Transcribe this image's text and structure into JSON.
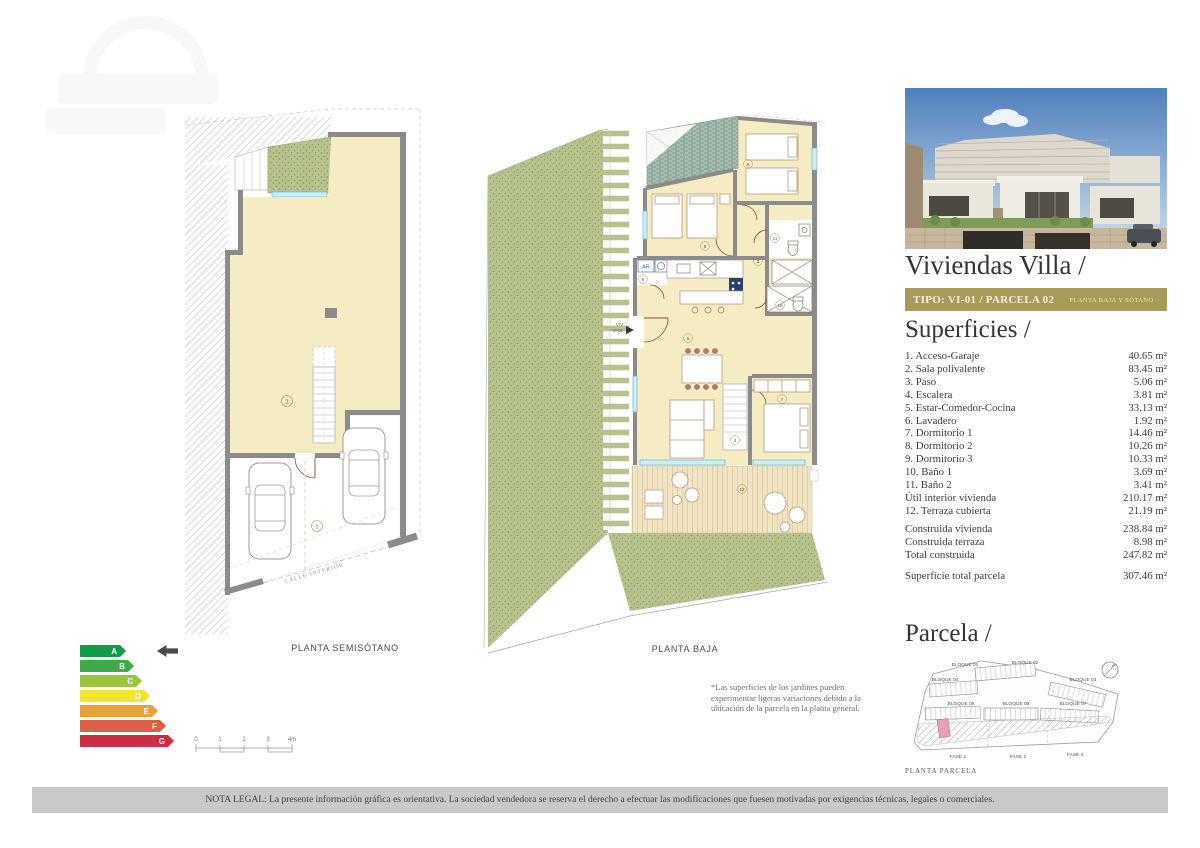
{
  "right_panel": {
    "title": "Viviendas Villa /",
    "tipo_bar": {
      "main": "TIPO: VI-01 / PARCELA 02",
      "sub": "PLANTA BAJA Y SÓTANO",
      "bg_color": "#a89a59"
    },
    "superficies": {
      "heading": "Superficies /",
      "rows": [
        {
          "label": "1. Acceso-Garaje",
          "value": "40.65 m²"
        },
        {
          "label": "2. Sala polivalente",
          "value": "83.45 m²"
        },
        {
          "label": "3. Paso",
          "value": "5.06 m²"
        },
        {
          "label": "4. Escalera",
          "value": "3.81 m²"
        },
        {
          "label": "5. Estar-Comedor-Cocina",
          "value": "33.13 m²"
        },
        {
          "label": "6. Lavadero",
          "value": "1.92 m²"
        },
        {
          "label": "7. Dormitorio 1",
          "value": "14.46 m²"
        },
        {
          "label": "8. Dormitorio 2",
          "value": "10.26 m²"
        },
        {
          "label": "9. Dormitorio 3",
          "value": "10.33 m²"
        },
        {
          "label": "10. Baño 1",
          "value": "3.69 m²"
        },
        {
          "label": "11. Baño 2",
          "value": "3.41 m²"
        },
        {
          "label": "Útil interior vivienda",
          "value": "210.17 m²"
        },
        {
          "label": "12. Terraza cubierta",
          "value": "21.19 m²"
        }
      ],
      "totals": [
        {
          "label": "Construida vivienda",
          "value": "238.84 m²"
        },
        {
          "label": "Construida terraza",
          "value": "8.98 m²"
        },
        {
          "label": "Total construida",
          "value": "247.82 m²"
        }
      ],
      "parcel_total": {
        "label": "Superficie total parcela",
        "value": "307.46 m²"
      }
    },
    "parcela": {
      "heading": "Parcela /",
      "caption": "PLANTA PARCELA",
      "blocks": [
        "BLOQUE 01",
        "BLOQUE 02",
        "BLOQUE 03",
        "BLOQUE 04",
        "BLOQUE 05",
        "BLOQUE 06",
        "BLOQUE 07"
      ],
      "fases": [
        "FASE 1",
        "FASE 2",
        "FASE 3"
      ],
      "highlight_color": "#e79fb4"
    }
  },
  "plans": {
    "semisotano": {
      "label": "PLANTA SEMISÓTANO",
      "street_label": "CALLE INTERIOR",
      "rooms": [
        "1",
        "2"
      ]
    },
    "baja": {
      "label": "PLANTA BAJA",
      "unit_label": {
        "line1": "VIV",
        "line2": "VI-01"
      },
      "ar_label": "AR",
      "rooms": [
        "3",
        "4",
        "5",
        "6",
        "7",
        "8",
        "9",
        "10",
        "11",
        "12"
      ]
    },
    "note": "*Las superficies de los jardines pueden experimentar ligeras variaciones debido a la ubicación de la parcela en la planta general."
  },
  "energy": {
    "grades": [
      {
        "letter": "A",
        "color": "#119a48"
      },
      {
        "letter": "B",
        "color": "#3cab49"
      },
      {
        "letter": "C",
        "color": "#9cc43c"
      },
      {
        "letter": "D",
        "color": "#f2e434"
      },
      {
        "letter": "E",
        "color": "#e5a33c"
      },
      {
        "letter": "F",
        "color": "#dd5f45"
      },
      {
        "letter": "G",
        "color": "#cb2e44"
      }
    ],
    "selected": "A",
    "arrow_color": "#4a4a4a"
  },
  "scale_bar": {
    "ticks": [
      "0",
      "1",
      "2",
      "3",
      "4m"
    ]
  },
  "legal": "NOTA LEGAL: La presente información gráfica es orientativa. La sociedad vendedora se reserva el derecho a efectuar las modificaciones que fuesen motivadas por exigencias técnicas, legales o comerciales."
}
